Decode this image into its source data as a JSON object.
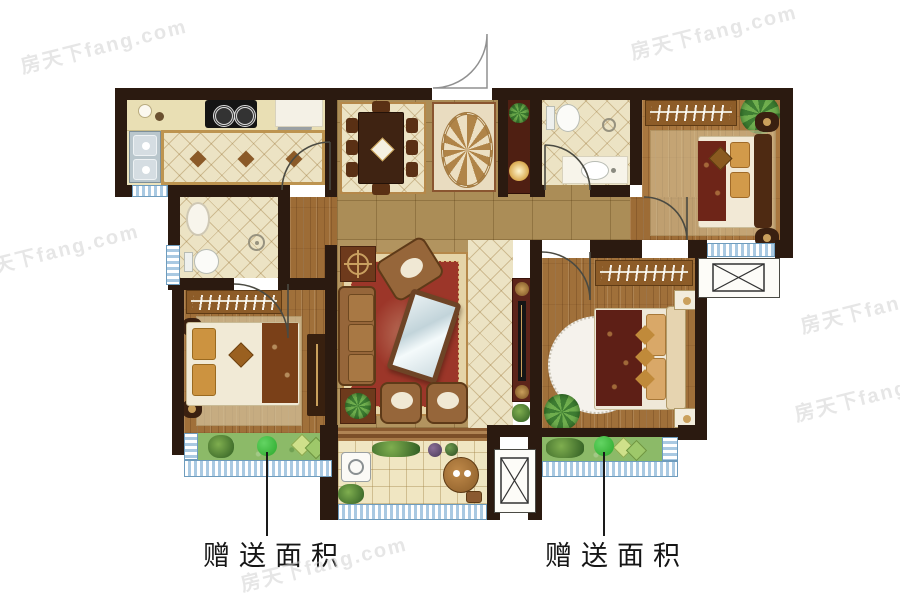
{
  "canvas": {
    "width": 900,
    "height": 600,
    "background": "#ffffff"
  },
  "watermark": {
    "text": "房天下fang.com"
  },
  "annotations": [
    {
      "id": "bonus-left",
      "label": "赠送面积"
    },
    {
      "id": "bonus-right",
      "label": "赠送面积"
    }
  ],
  "legend": {
    "marker_icon": "green-dot-marker",
    "ac_platform_icon": "crossed-box",
    "door_icon": "quarter-arc"
  },
  "colors": {
    "wall": "#2b1a10",
    "window_blue": "#a9c9e2",
    "bonus_green": "#8cba68",
    "marker_green": "#2fbe2f",
    "rug_red": "#9c3629",
    "wood_floor": "#a0703a",
    "tile_tan": "#ab8d57",
    "tile_pale": "#ece3c4",
    "label_text": "#161616"
  }
}
